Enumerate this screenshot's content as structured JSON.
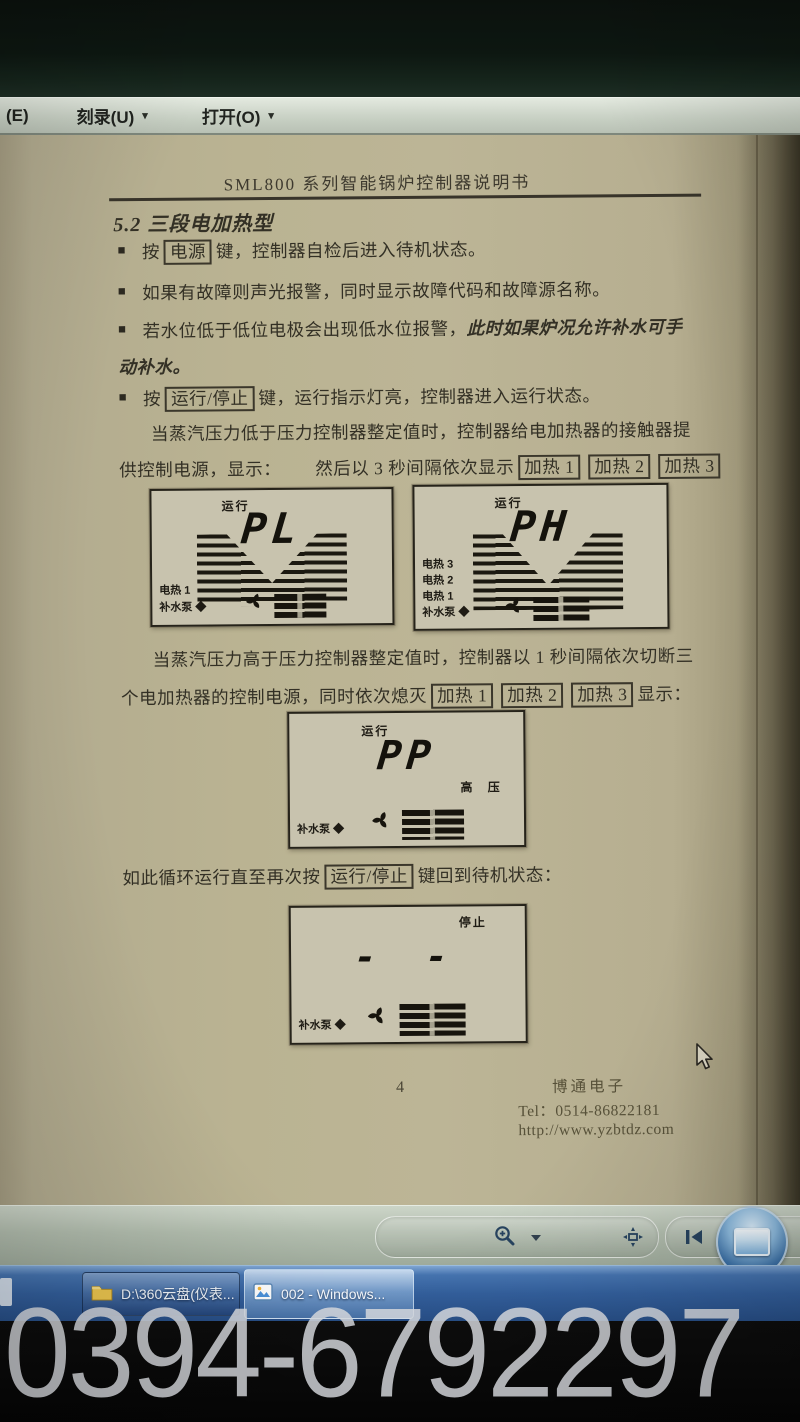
{
  "menu": {
    "item_e": "(E)",
    "item_burn": "刻录(U)",
    "item_open": "打开(O)",
    "caret": "▾"
  },
  "document": {
    "header_title": "SML800 系列智能锅炉控制器说明书",
    "section_heading": "5.2 三段电加热型",
    "bullet_marker": "■",
    "bullets": {
      "b1": {
        "pre": "按",
        "key": "电源",
        "post": "键，控制器自检后进入待机状态。"
      },
      "b2": {
        "text": "如果有故障则声光报警，同时显示故障代码和故障源名称。"
      },
      "b3": {
        "normal": "若水位低于低位电极会出现低水位报警，",
        "italic_line1": "此时如果炉况允许补水可手",
        "italic_line2": "动补水。"
      },
      "b4": {
        "pre": "按",
        "key": "运行/停止",
        "post": "键，运行指示灯亮，控制器进入运行状态。"
      }
    },
    "para_low": {
      "line1": "当蒸汽压力低于压力控制器整定值时，控制器给电加热器的接触器提",
      "line2": "供控制电源，显示：",
      "mid": "然后以 3 秒间隔依次显示",
      "key1": "加热 1",
      "key2": "加热 2",
      "key3": "加热 3"
    },
    "para_high": {
      "line1": "当蒸汽压力高于压力控制器整定值时，控制器以 1 秒间隔依次切断三",
      "line2": "个电加热器的控制电源，同时依次熄灭",
      "key1": "加热 1",
      "key2": "加热 2",
      "key3": "加热 3",
      "post": "显示："
    },
    "loop_line": {
      "pre": "如此循环运行直至再次按",
      "key": "运行/停止",
      "post": "键回到待机状态："
    },
    "displays": {
      "pl": {
        "status": "运行",
        "value": "PL",
        "label1": "电热 1",
        "label2": "补水泵 ◆"
      },
      "ph": {
        "status": "运行",
        "value": "PH",
        "label1": "电热 3",
        "label2": "电热 2",
        "label3": "电热 1",
        "label4": "补水泵 ◆"
      },
      "pp": {
        "status": "运行",
        "value": "PP",
        "side_label": "高 压",
        "label1": "补水泵 ◆"
      },
      "stop": {
        "status": "停止",
        "value": "- -",
        "label1": "补水泵 ◆"
      }
    },
    "footer": {
      "page_number": "4",
      "company": "博通电子",
      "tel": "Tel：0514-86822181",
      "url": "http://www.yzbtdz.com"
    }
  },
  "viewer_toolbar": {
    "icons": {
      "zoom": "magnifier-plus",
      "fit": "actual-size",
      "previous": "previous-page",
      "slideshow": "slideshow-screen"
    }
  },
  "taskbar": {
    "buttons": [
      {
        "label": "D:\\360云盘(仪表..."
      },
      {
        "label": "002 - Windows..."
      }
    ]
  },
  "watermark": {
    "text": "0394-6792297"
  },
  "colors": {
    "taskbar_blue": "#3a6aa8",
    "paper": "#bab392",
    "menu_gray": "#c9d1c5",
    "watermark_gray": "#d9dce0"
  }
}
